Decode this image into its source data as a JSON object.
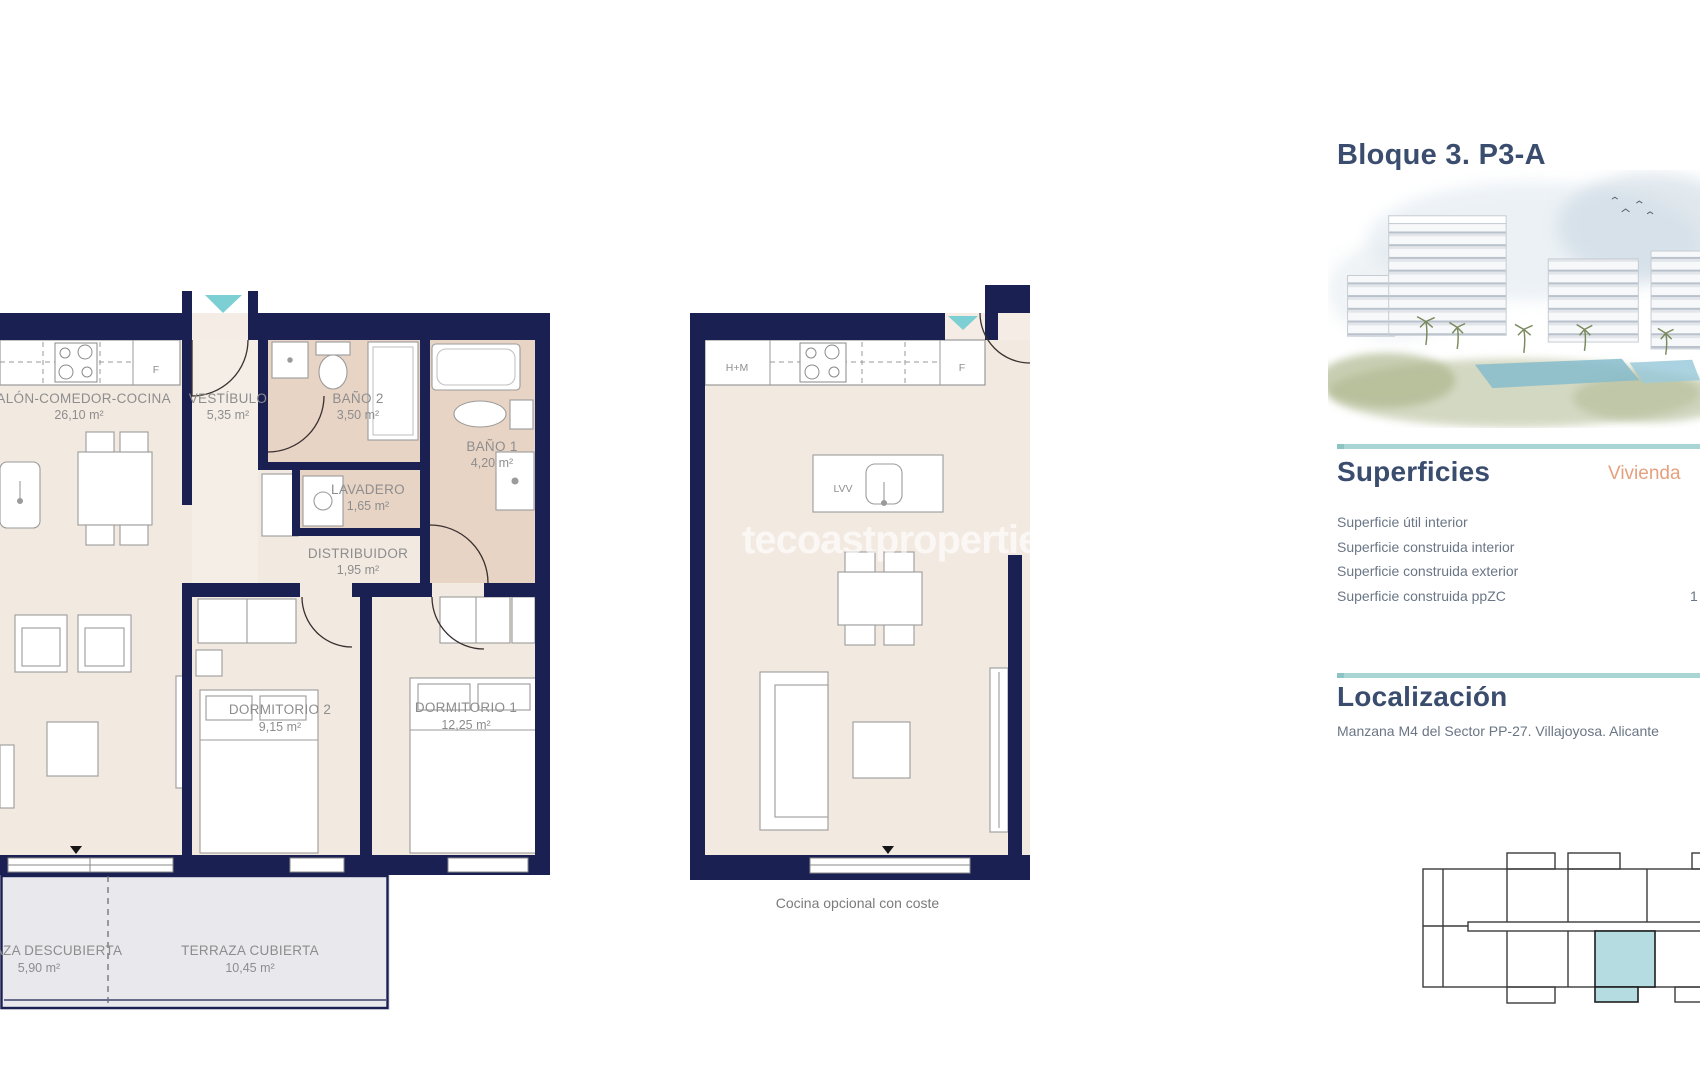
{
  "header": {
    "title": "Bloque 3. P3-A"
  },
  "superficies": {
    "heading": "Superficies",
    "column_label": "Vivienda",
    "rows": [
      {
        "label": "Superficie útil interior",
        "value": ""
      },
      {
        "label": "Superficie construida interior",
        "value": ""
      },
      {
        "label": "Superficie construida exterior",
        "value": ""
      },
      {
        "label": "Superficie construida ppZC",
        "value": "1"
      }
    ]
  },
  "localizacion": {
    "heading": "Localización",
    "text": "Manzana M4 del Sector PP-27. Villajoyosa. Alicante"
  },
  "watermark": {
    "text": "tecoastproperties.com"
  },
  "plans": {
    "left": {
      "rooms": [
        {
          "name": "SALÓN-COMEDOR-COCINA",
          "area": "26,10 m²"
        },
        {
          "name": "VESTÍBULO",
          "area": "5,35 m²"
        },
        {
          "name": "BAÑO 2",
          "area": "3,50 m²"
        },
        {
          "name": "BAÑO 1",
          "area": "4,20 m²"
        },
        {
          "name": "LAVADERO",
          "area": "1,65 m²"
        },
        {
          "name": "DISTRIBUIDOR",
          "area": "1,95 m²"
        },
        {
          "name": "DORMITORIO 2",
          "area": "9,15 m²"
        },
        {
          "name": "DORMITORIO 1",
          "area": "12,25 m²"
        },
        {
          "name": "TERRAZA DESCUBIERTA",
          "area": "5,90 m²"
        },
        {
          "name": "TERRAZA CUBIERTA",
          "area": "10,45 m²"
        }
      ],
      "labels": {
        "fridge": "F"
      }
    },
    "middle": {
      "labels": {
        "washer": "H+M",
        "fridge": "F",
        "dishwasher": "LVV"
      },
      "caption": "Cocina opcional con coste"
    }
  },
  "colors": {
    "wall_navy": "#1b2052",
    "floor_beige": "#f2e9e1",
    "bath_tan": "#e8d4c5",
    "terrace_gray": "#e8e8ed",
    "accent_teal": "#a9d5d4",
    "entry_arrow_teal": "#7ccfd3",
    "highlight_unit_blue": "#b5dce1",
    "heading_blue": "#3b4d6e",
    "vivienda_orange": "#e5a07e"
  }
}
